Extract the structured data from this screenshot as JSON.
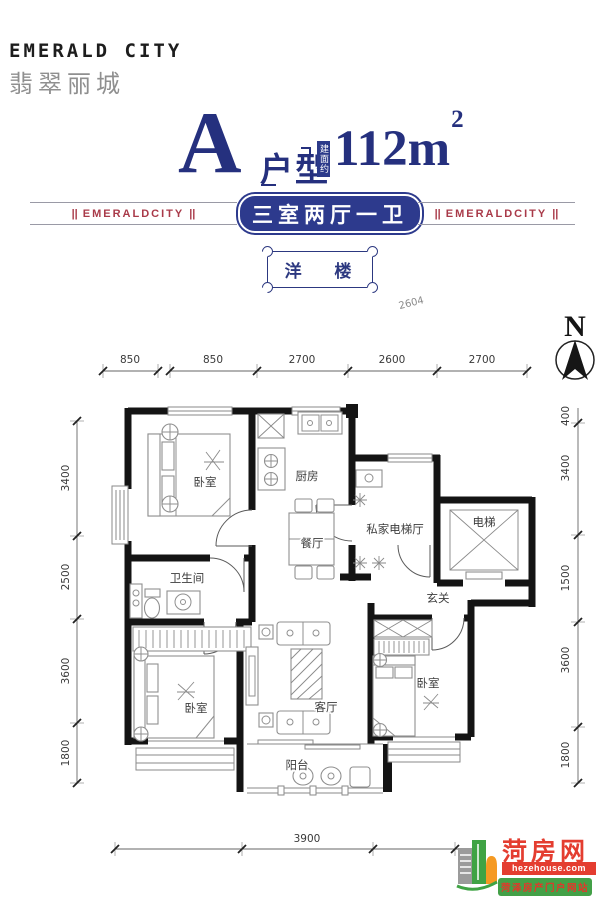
{
  "brand": {
    "name_en": "EMERALD CITY",
    "name_cn": "翡翠丽城"
  },
  "title": {
    "unit_letter": "A",
    "unit_type_label": "户型",
    "area_prefix": "建面约",
    "area_value": "112m",
    "area_superscript": "2"
  },
  "banner": {
    "side_label": "EMERALDCITY",
    "side_separator": "||",
    "headline": "三室两厅一卫",
    "building_type": "洋 楼"
  },
  "compass": {
    "north_label": "N"
  },
  "plan": {
    "rooms": [
      {
        "id": "bedroom-top",
        "label": "卧室"
      },
      {
        "id": "kitchen",
        "label": "厨房"
      },
      {
        "id": "dining-room",
        "label": "餐厅"
      },
      {
        "id": "private-elevator-hall",
        "label": "私家电梯厅"
      },
      {
        "id": "elevator",
        "label": "电梯"
      },
      {
        "id": "bathroom",
        "label": "卫生间"
      },
      {
        "id": "foyer",
        "label": "玄关"
      },
      {
        "id": "bedroom-bottom-left",
        "label": "卧室"
      },
      {
        "id": "living-room",
        "label": "客厅"
      },
      {
        "id": "bedroom-bottom-right",
        "label": "卧室"
      },
      {
        "id": "balcony",
        "label": "阳台"
      }
    ],
    "dimensions": {
      "top": [
        "850",
        "850",
        "2700",
        "2600",
        "2700"
      ],
      "left": [
        "3400",
        "2500",
        "3600",
        "1800"
      ],
      "right": [
        "400",
        "3400",
        "1500",
        "3600",
        "1800"
      ],
      "bottom": [
        "3900"
      ],
      "stray_label": "2604"
    }
  },
  "watermark": {
    "site_name": "菏房网",
    "site_url": "hezehouse.com",
    "site_tagline": "菏泽房产门户网站"
  },
  "colors": {
    "title_navy": "#25307e",
    "banner_navy": "#2d3a8d",
    "banner_red": "#a93a49",
    "wall_black": "#141414",
    "logo_red": "#e43d30",
    "logo_green": "#3fa344",
    "logo_orange": "#f59a23"
  }
}
